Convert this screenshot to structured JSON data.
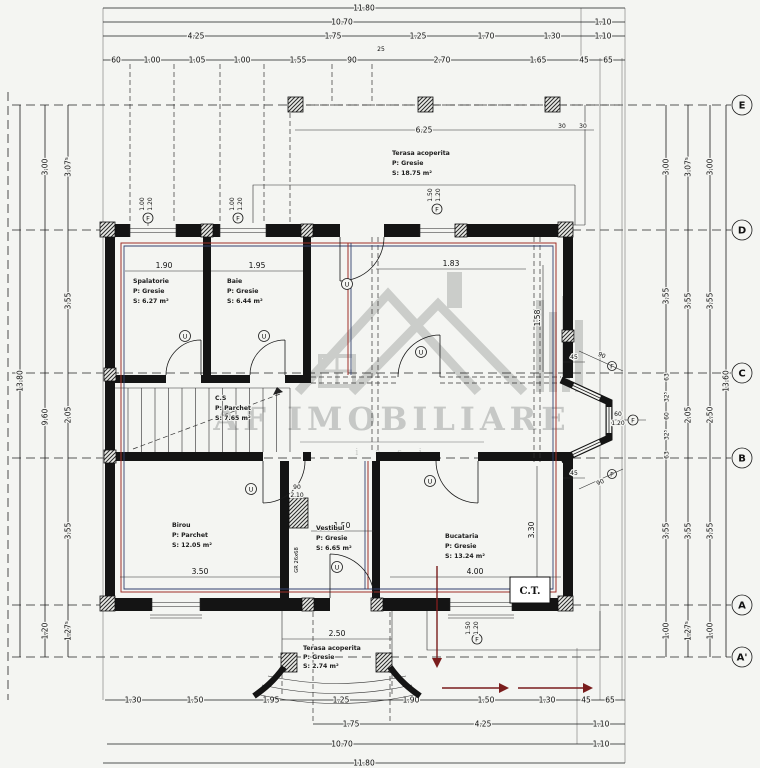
{
  "watermark": {
    "title": "AF IMOBILIARE",
    "subtitle": "i a s i"
  },
  "grid": {
    "labels": [
      "E",
      "D",
      "C",
      "B",
      "A",
      "A'"
    ]
  },
  "rooms": {
    "terasa_top": {
      "name": "Terasa acoperita",
      "floor": "P: Gresie",
      "area": "S: 18.75 m²"
    },
    "spalatorie": {
      "name": "Spalatorie",
      "floor": "P: Gresie",
      "area": "S: 6.27 m²"
    },
    "baie": {
      "name": "Baie",
      "floor": "P: Gresie",
      "area": "S: 6.44 m²"
    },
    "cs": {
      "name": "C.S",
      "floor": "P: Parchet",
      "area": "S: 7.65 m²"
    },
    "birou": {
      "name": "Birou",
      "floor": "P: Parchet",
      "area": "S: 12.05 m²"
    },
    "vestibul": {
      "name": "Vestibul",
      "floor": "P: Gresie",
      "area": "S: 6.65 m²"
    },
    "bucataria": {
      "name": "Bucataria",
      "floor": "P: Gresie",
      "area": "S: 13.24 m²"
    },
    "terasa_bottom": {
      "name": "Terasa acoperita",
      "floor": "P: Gresie",
      "area": "S: 2.74 m²"
    },
    "ct": "C.T."
  },
  "dims": {
    "top": {
      "r1": [
        "11.80"
      ],
      "r2": [
        "10.70",
        "1.10"
      ],
      "r3": [
        "4.25",
        "1.75",
        "1.25",
        "1.70",
        "1.30",
        "1.10"
      ],
      "r3_small": "25",
      "r4": [
        "60",
        "1.00",
        "1.05",
        "1.00",
        "1.55",
        "90",
        "2.70",
        "1.65",
        "45",
        "65"
      ]
    },
    "bottom": {
      "r1": [
        "1.30",
        "1.50",
        "1.95",
        "1.25",
        "1.90",
        "1.50",
        "1.30",
        "45",
        "65"
      ],
      "r2": [
        "1.75",
        "4.25",
        "1.10"
      ],
      "r3": [
        "10.70",
        "1.10"
      ],
      "r4": [
        "11.80"
      ]
    },
    "left": {
      "total": "13.80",
      "col2": [
        "3.00",
        "9.60",
        "1.20"
      ],
      "col3": [
        "3.07⁵",
        "3.55",
        "2.05",
        "3.55",
        "1.27⁵"
      ]
    },
    "right": {
      "col1": [
        "3.00",
        "3.55",
        "3.55",
        "1.00"
      ],
      "bay_chain": [
        "63",
        "32⁵",
        "60",
        "32⁵",
        "63"
      ],
      "col2": [
        "3.07⁵",
        "3.55",
        "2.05",
        "3.55",
        "1.27⁵"
      ],
      "col3": [
        "3.00",
        "3.55",
        "2.50",
        "3.55",
        "1.00"
      ],
      "total": "13.60"
    },
    "interior": {
      "spalatorie": "1.90",
      "baie": "1.95",
      "living": "1.83",
      "terrace": "6.25",
      "roof1": "30",
      "roof2": "30",
      "birou": "3.50",
      "vestibul": "1.50",
      "kitchen_w": "4.00",
      "kitchen_h": "3.30",
      "wall_right": "1.58",
      "terrace_small": "2.50",
      "door_w": "90",
      "door_h": "2.10",
      "flue": "GR 26x68",
      "bay_45a": "45",
      "bay_45b": "45",
      "bay_90a": "90",
      "bay_90b": "90",
      "bay_win_w": "60",
      "bay_win_h": "1.20"
    },
    "windows": {
      "top1": [
        "1.00",
        "1.20"
      ],
      "top2": [
        "1.00",
        "1.20"
      ],
      "center": [
        "1.50",
        "1.20"
      ],
      "bottom": [
        "1.50",
        "1.20"
      ]
    }
  },
  "symbols": {
    "door": "U",
    "window": "F"
  }
}
